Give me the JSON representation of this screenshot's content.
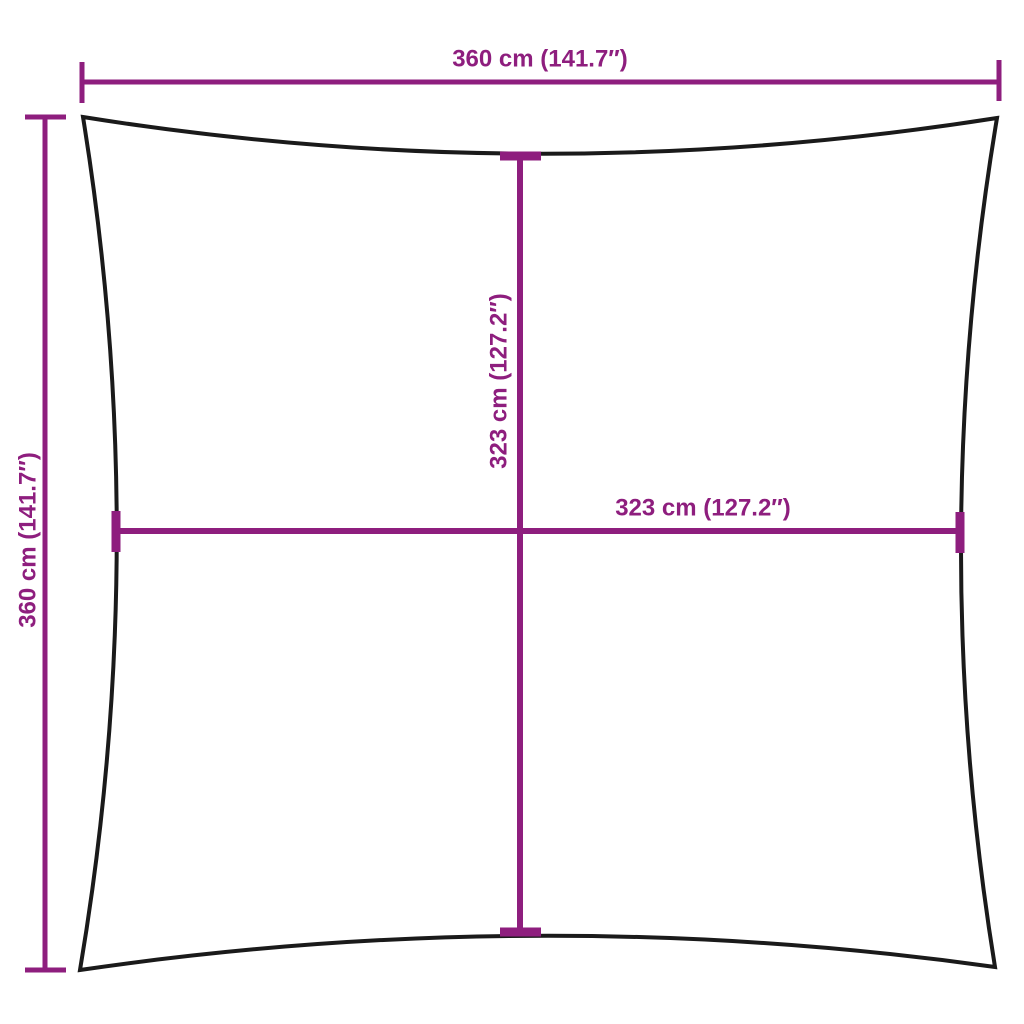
{
  "diagram": {
    "type": "product-dimension-diagram",
    "shape": "square-shade-sail-concave-edges"
  },
  "colors": {
    "dimension": "#8e1e7e",
    "outline": "#1a1a1a",
    "background": "#ffffff"
  },
  "dimensions": {
    "outer_width": {
      "label": "360 cm (141.7″)",
      "value_cm": 360,
      "value_in": 141.7,
      "position": "top"
    },
    "outer_height": {
      "label": "360 cm (141.7″)",
      "value_cm": 360,
      "value_in": 141.7,
      "position": "left"
    },
    "inner_height": {
      "label": "323 cm (127.2″)",
      "value_cm": 323,
      "value_in": 127.2,
      "position": "center-vertical"
    },
    "inner_width": {
      "label": "323 cm (127.2″)",
      "value_cm": 323,
      "value_in": 127.2,
      "position": "center-horizontal"
    }
  }
}
